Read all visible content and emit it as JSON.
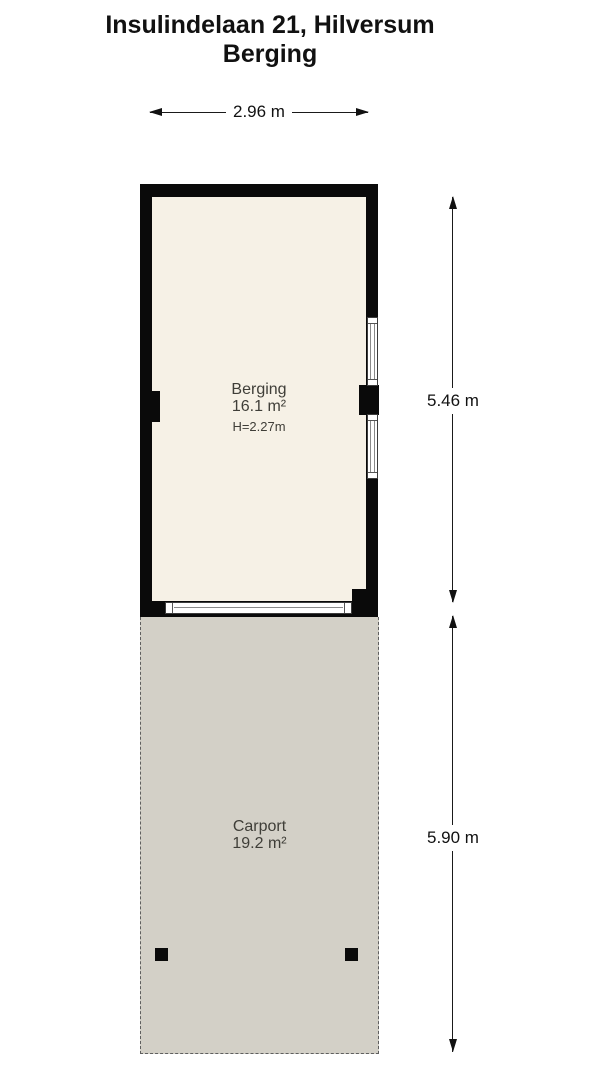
{
  "title": {
    "address": "Insulindelaan 21, Hilversum",
    "plan_name": "Berging"
  },
  "dimensions": {
    "top_width": "2.96 m",
    "berging_height": "5.46 m",
    "carport_height": "5.90 m"
  },
  "rooms": {
    "berging": {
      "name": "Berging",
      "area": "16.1 m²",
      "ceiling_height": "H=2.27m"
    },
    "carport": {
      "name": "Carport",
      "area": "19.2 m²"
    }
  },
  "colors": {
    "wall": "#0a0a0a",
    "berging_floor": "#f6f1e6",
    "carport_floor": "#d3d0c7",
    "background": "#ffffff",
    "dimension_line": "#1a1a1a",
    "room_label_text": "#3f3e38"
  }
}
